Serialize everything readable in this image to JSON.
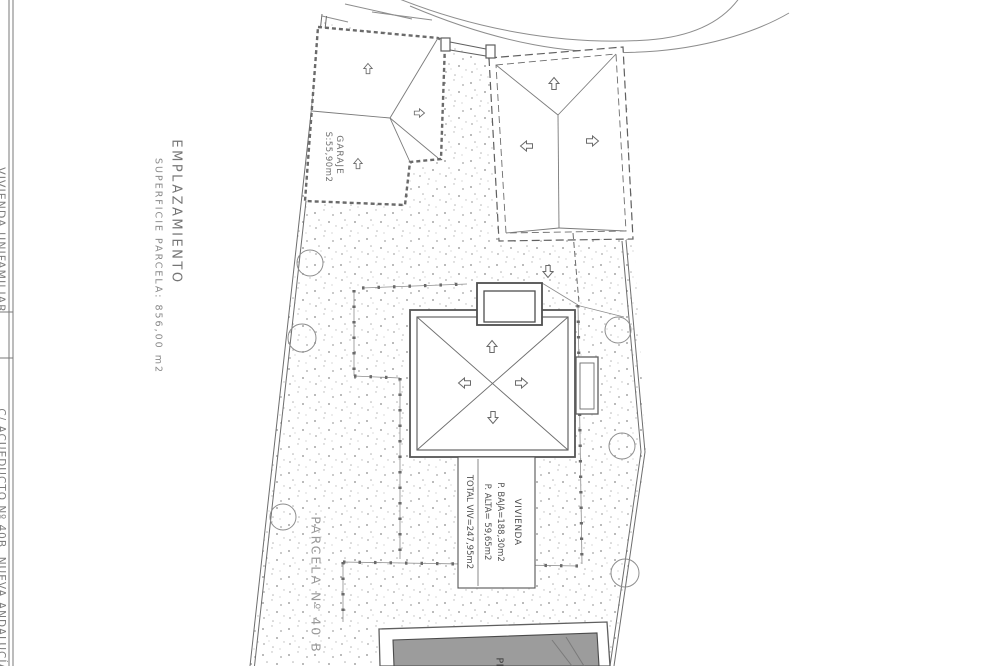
{
  "title_block": {
    "project": "VIVIENDA UNIFAMILIAR",
    "address": "C/ ACUEDUCTO Nº 40B, NUEVA ANDALUCÍA"
  },
  "plan": {
    "title": "EMPLAZAMIENTO",
    "subtitle": "SUPERFICIE PARCELA: 856,00 m2",
    "parcel_label": "PARCELA Nº 40 B"
  },
  "garage": {
    "label": "GARAJE",
    "area": "S:55,90m2"
  },
  "dwelling": {
    "label": "VIVIENDA",
    "ground_floor": "P. BAJA=188,30m2",
    "upper_floor": "P. ALTA= 59,65m2",
    "total": "TOTAL VIV=247,95m2"
  },
  "pool": {
    "label": "PISCINA",
    "area_prefix": "S:"
  },
  "colors": {
    "pencil_line": "#5f5f5f",
    "faint_line": "#8d8d8d",
    "stipple_dot": "#a5a5a5",
    "pool_fill": "#9c9c9c",
    "paper": "#ffffff"
  }
}
